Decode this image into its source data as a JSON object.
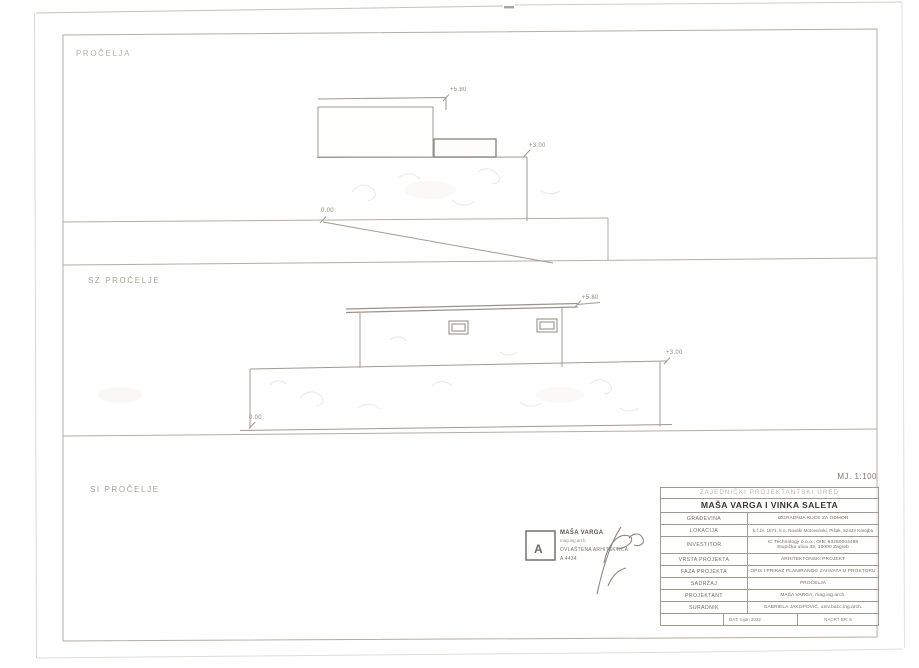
{
  "sheet": {
    "scale_label": "MJ. 1:100",
    "sections": {
      "top_label": "PROČELJA",
      "mid_label": "SZ PROČELJE",
      "bottom_label": "SI PROČELJE"
    },
    "markers": {
      "e1_top": "+5.80",
      "e1_mid": "+3.00",
      "e1_ground": "0.00",
      "e2_top": "+5.80",
      "e2_mid": "+3.00",
      "e2_ground": "0.00"
    },
    "stamp": {
      "monogram": "A",
      "name": "MAŠA VARGA",
      "title": "mag.ing.arch.",
      "license": "OVLAŠTENA ARHITEKTICA",
      "number": "A 4434"
    },
    "titleblock": {
      "office": "ZAJEDNIČKI PROJEKTANTSKI URED",
      "architects": "MAŠA VARGA I VINKA SALETA",
      "rows": [
        {
          "label": "GRAĐEVINA",
          "value": "IZGRADNJA KUĆE ZA ODMOR"
        },
        {
          "label": "LOKACIJA",
          "value": "k.č.br. 1671, k.o. Novaki Motovunski, Pišak, 52423 Karojba"
        },
        {
          "label": "INVESTITOR",
          "value": "IC Technology d.o.o., OIB: 63250004488",
          "value2": "Stupička ulica 33, 10000 Zagreb"
        },
        {
          "label": "VRSTA PROJEKTA",
          "value": "ARHITEKTONSKI PROJEKT"
        },
        {
          "label": "FAZA PROJEKTA",
          "value": "OPIS I PRIKAZ PLANIRANOG ZAHVATA U PROSTORU"
        },
        {
          "label": "SADRŽAJ",
          "value": "PROČELJA"
        },
        {
          "label": "PROJEKTANT",
          "value": "MAŠA VARGA, mag.ing.arch."
        },
        {
          "label": "SURADNIK",
          "value": "GABRIELA JAKOPOVIĆ, univ.bacc.ing.arch."
        }
      ],
      "date": "DAT: rujan 2022.",
      "sheet_no": "NACRT BR: 6"
    },
    "colors": {
      "frame_line": "#b4aea5",
      "drawing_line": "#a09a92",
      "dark_line": "#8f8a83",
      "label_text": "#a8a29a"
    }
  }
}
